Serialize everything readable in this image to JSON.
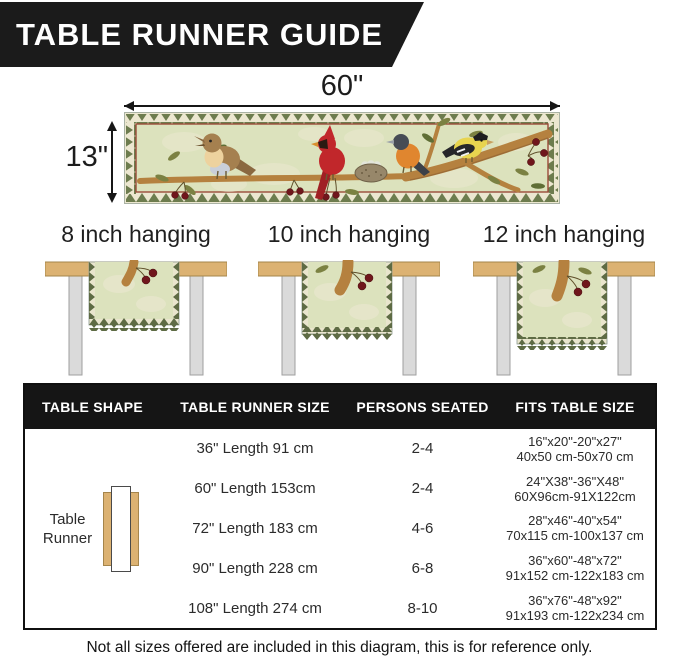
{
  "banner": {
    "title": "TABLE RUNNER GUIDE"
  },
  "runner_diagram": {
    "width_label": "60\"",
    "height_label": "13\""
  },
  "hanging_options": [
    {
      "label": "8 inch hanging"
    },
    {
      "label": "10 inch hanging"
    },
    {
      "label": "12 inch hanging"
    }
  ],
  "size_table": {
    "headers": [
      "TABLE SHAPE",
      "TABLE RUNNER SIZE",
      "PERSONS SEATED",
      "FITS TABLE SIZE"
    ],
    "shape": {
      "line1": "Table",
      "line2": "Runner"
    },
    "rows": [
      {
        "size": "36\" Length 91 cm",
        "persons": "2-4",
        "fits1": "16\"x20\"-20\"x27\"",
        "fits2": "40x50 cm-50x70 cm"
      },
      {
        "size": "60\" Length 153cm",
        "persons": "2-4",
        "fits1": "24\"X38\"-36\"X48\"",
        "fits2": "60X96cm-91X122cm"
      },
      {
        "size": "72\" Length 183 cm",
        "persons": "4-6",
        "fits1": "28\"x46\"-40\"x54\"",
        "fits2": "70x115 cm-100x137 cm"
      },
      {
        "size": "90\" Length 228 cm",
        "persons": "6-8",
        "fits1": "36\"x60\"-48\"x72\"",
        "fits2": "91x152 cm-122x183 cm"
      },
      {
        "size": "108\" Length 274 cm",
        "persons": "8-10",
        "fits1": "36\"x76\"-48\"x92\"",
        "fits2": "91x193 cm-122x234 cm"
      }
    ]
  },
  "footnote": "Not all sizes offered are included in this diagram, this is for reference only.",
  "colors": {
    "banner_bg": "#1b1b1b",
    "header_bg": "#151515",
    "runner_field_green": "#dce2bd",
    "zigzag_green": "#6d7c4e",
    "border_maroon": "#9a4b38",
    "wood_tan": "#dcb272",
    "leg_gray": "#dadada",
    "cardinal_red": "#c1272b",
    "goldfinch_yellow": "#e8d44f",
    "oriole_orange": "#e0862f",
    "robin_brown": "#a5804f",
    "cherry_red": "#70161c"
  }
}
